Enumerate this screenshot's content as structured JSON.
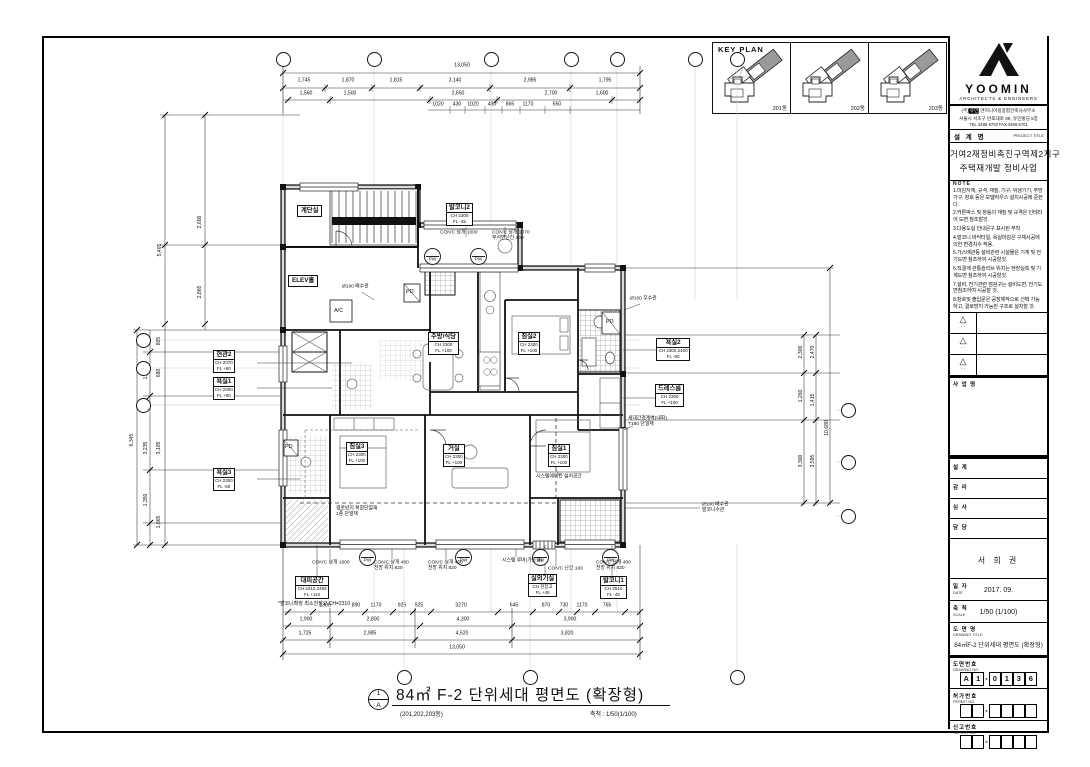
{
  "sheet": {
    "key_plan": {
      "title": "KEY PLAN",
      "panels": [
        {
          "label": "201동"
        },
        {
          "label": "202동"
        },
        {
          "label": "203동"
        }
      ]
    },
    "main_title": {
      "text": "84㎡ F-2 단위세대 평면도 (확장형)",
      "sub": "(201,202,203동)",
      "scale": "축척 : 1/50(1/100)",
      "bubble_top": "1",
      "bubble_bottom": "A"
    }
  },
  "title_block": {
    "logo": {
      "name": "YOOMIN",
      "sub": "ARCHITECTS & ENGINEERS"
    },
    "company_prefix": "(주)",
    "company_mark": "유민",
    "company_rest": " 엔지니어링종합건축사사무소",
    "address": "서울시 서초구 반포대로 89, 유민빌딩 5층",
    "tel": "TEL.3485-5703 FAX.3486-6701",
    "project": {
      "label": "설 계 명",
      "label_en": "PROJECT TITLE",
      "name_line1": "거여2재정비촉진구역제2지구",
      "name_line2": "주택재개발 정비사업"
    },
    "notes_title": "NOTE",
    "notes": [
      "1.마감자재, 규격, 재질, 기구, 위생기기, 주방가구, 창호 등은 모델하우스 설치시공에 준한다.",
      "2.커튼박스 및 창틀의 재질 및 규격은 인테리어 도면 참조할것.",
      "3.다용도실 안내문구 표시된 부착",
      "4.발코니 바닥타일, 욕실마감은 구체시공에 의한 변경치수 적용.",
      "5.가스배관등 설비관련 시설물은 기계 및 전기도면 참조하여 시공할것.",
      "6.직결계 관통슬리브 위치는 현장실측 및 기계도면 참조하여 시공할것.",
      "7.설비, 전기관련 점검구는 설비도면, 전기도면참조하여 시공할 것.",
      "8.창호및 출입문은 공장제작으로 선택 가능하고, 결로방지 가능한 구조로 설치할 것."
    ],
    "revision_mark": "△",
    "revision_dots": "· ·",
    "section_a_label": "사 업 명",
    "rows": [
      {
        "label": "설  계",
        "value": ""
      },
      {
        "label": "감  리",
        "value": ""
      },
      {
        "label": "심  사",
        "value": ""
      },
      {
        "label": "담  당",
        "value": ""
      }
    ],
    "sign_name": "서 희 권",
    "date": {
      "label": "일  자",
      "en": "DATE",
      "value": "2017. 09."
    },
    "scale": {
      "label": "축  척",
      "en": "SCALE",
      "value": "1/50 (1/100)"
    },
    "drawing_title": {
      "label": "도 면 명",
      "en": "DRAWING TITLE",
      "value": "84㎡F-2 단위세대 평면도 (확장형)"
    },
    "drawing_no": {
      "label": "도면번호",
      "en": "DRAWING NO.",
      "boxes": [
        "A",
        "1",
        "0",
        "1",
        "3",
        "6"
      ],
      "separator": "-"
    },
    "permit_no": {
      "label": "허가번호",
      "en": "PERMIT NO."
    },
    "report_no": {
      "label": "신고번호",
      "en": "REPORT NO."
    }
  },
  "plan": {
    "rooms": {
      "stair": "계단실",
      "elev": "ELEV홀",
      "pd": "PD",
      "ac": "A/C",
      "balcony2": {
        "name": "발코니2",
        "ch": "CH 2300",
        "fl": "FL -45"
      },
      "kitchen": {
        "name": "주방/식당",
        "ch": "CH 2300",
        "fl": "FL +100"
      },
      "bed2": {
        "name": "침실2",
        "ch": "CH 2300",
        "fl": "FL +100"
      },
      "bed3": {
        "name": "침실3",
        "ch": "CH 2300",
        "fl": "FL +100"
      },
      "living": {
        "name": "거실",
        "ch": "CH 2300",
        "fl": "FL +100"
      },
      "bed1": {
        "name": "침실1",
        "ch": "CH 2300",
        "fl": "FL +100"
      }
    },
    "tags_left": [
      {
        "name": "현관2",
        "ch": "CH 2070",
        "fl": "FL +50"
      },
      {
        "name": "욕실1",
        "ch": "CH 2300",
        "fl": "FL +50"
      },
      {
        "name": "욕실3",
        "ch": "CH 2300",
        "fl": "FL -50"
      }
    ],
    "tags_right": [
      {
        "name": "욕실2",
        "ch": "CH 2300,2400",
        "fl": "FL -50"
      },
      {
        "name": "드레스룸",
        "ch": "CH 2300",
        "fl": "FL +100"
      }
    ],
    "tags_bottom": [
      {
        "name": "대피공간",
        "ch": "CH 2312,2456",
        "fl": "FL +110"
      },
      {
        "name": "실외기실",
        "ch": "CH 천장고",
        "fl": "FL +45"
      },
      {
        "name": "발코니1",
        "ch": "CH 2510",
        "fl": "FL -45"
      }
    ],
    "bottom_note": "*발코니확장 최소천장고 CH=2310",
    "window_tags": [
      {
        "code": "PW"
      },
      {
        "code": "PW"
      },
      {
        "code": "PW"
      },
      {
        "code": "PW"
      },
      {
        "code": "AW"
      },
      {
        "code": "PW"
      }
    ],
    "annotations": [
      "CON'C 날개 1000",
      "CON'C 날개 1070\n무석면난간 200",
      "Ø100 배수관",
      "Ø100 우수관",
      "세대간경계벽(내화)\nT180 단열재",
      "시스템에어컨 설치공간",
      "Ø100 배수관\n발코니수관",
      "CON'C 날개 1600",
      "CON'C 날개 400\n천장 위치 820",
      "CON'C 날개 400\n천장 위치 820",
      "시스템 루버(가동형)",
      "CON'C 난간 100",
      "CON'C 날개 400\n천장 위치 820",
      "결로방지 복합단열재\n1종 단열재"
    ]
  },
  "dims": {
    "top_total": "13,050",
    "top_row1": [
      "1,745",
      "1,870",
      "1,815",
      "3,140",
      "2,985",
      "1,795"
    ],
    "top_row2": [
      "1,560",
      "1,500",
      "2,650",
      "2,700",
      "1,600"
    ],
    "top_row3": [
      "1020",
      "430",
      "1020",
      "480",
      "865",
      "1170",
      "650"
    ],
    "bottom_row1": [
      "1300",
      "890",
      "1170",
      "925",
      "925",
      "3270",
      "645",
      "870",
      "730",
      "1170",
      "765"
    ],
    "bottom_row2": [
      "1,900",
      "2,800",
      "4,300",
      "3,900"
    ],
    "bottom_row3": [
      "1,725",
      "2,985",
      "4,520",
      "3,820"
    ],
    "bottom_total": "13,050",
    "left": {
      "total_upper": "5,465",
      "upper": [
        "2,600",
        "2,865"
      ],
      "total_lower": "6,345",
      "lower": [
        "885",
        "1,220",
        "680",
        "3,235",
        "3,105",
        "1,350",
        "1,065"
      ]
    },
    "right": {
      "vals": [
        "2,300",
        "2,470",
        "1,260",
        "1,415",
        "3,300",
        "3,595"
      ],
      "total": "10,680"
    }
  }
}
